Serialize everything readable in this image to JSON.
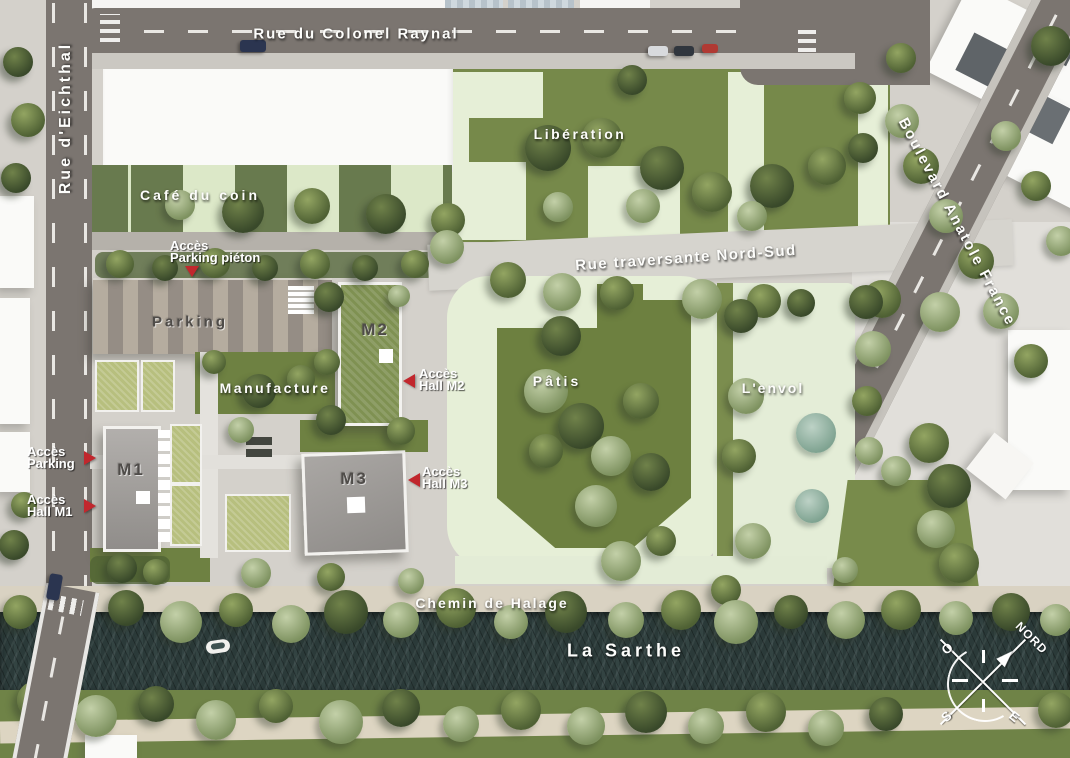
{
  "streets": {
    "colonel_raynal": "Rue du Colonel Raynal",
    "eichthal": "Rue d'Eichthal",
    "anatole_france": "Boulevard Anatole France",
    "traversante": "Rue traversante Nord-Sud",
    "halage": "Chemin de Halage"
  },
  "river": {
    "name": "La Sarthe"
  },
  "areas": {
    "liberation": "Libération",
    "cafe": "Café du coin",
    "parking": "Parking",
    "manufacture": "Manufacture",
    "patis": "Pâtis",
    "envol": "L'envol"
  },
  "buildings": {
    "m1": "M1",
    "m2": "M2",
    "m3": "M3"
  },
  "access": {
    "parking_pieton": [
      "Accès",
      "Parking piéton"
    ],
    "hall_m2": [
      "Accès",
      "Hall M2"
    ],
    "parking": [
      "Accès",
      "Parking"
    ],
    "hall_m1": [
      "Accès",
      "Hall M1"
    ],
    "hall_m3": [
      "Accès",
      "Hall M3"
    ]
  },
  "compass": {
    "north": "NORD",
    "west": "O",
    "south": "S",
    "east": "E"
  },
  "colors": {
    "marker_red": "#c1272d",
    "grass": "#76894a",
    "footprint_pale_green": "#e6efd7",
    "road_asphalt": "#7b7570",
    "river_water": "#2b3a39",
    "pavement": "#d4d1cb",
    "plaza": "#e1dfda",
    "garden_roof": "#b7bf7e",
    "parking_stripe_light": "#b5ac9f",
    "parking_stripe_dark": "#958d85"
  },
  "decor": {
    "trees": [
      [
        18,
        62,
        30,
        "dark"
      ],
      [
        28,
        120,
        34,
        "olive"
      ],
      [
        16,
        178,
        30,
        "dark"
      ],
      [
        24,
        505,
        26,
        "olive"
      ],
      [
        14,
        545,
        30,
        "dark"
      ],
      [
        243,
        212,
        42,
        "dark"
      ],
      [
        312,
        206,
        36,
        "olive"
      ],
      [
        386,
        214,
        40,
        "dark"
      ],
      [
        448,
        220,
        34,
        "olive"
      ],
      [
        180,
        205,
        30,
        "sage"
      ],
      [
        120,
        264,
        28,
        "olive"
      ],
      [
        165,
        268,
        26,
        "dark"
      ],
      [
        215,
        263,
        30,
        "olive"
      ],
      [
        265,
        268,
        26,
        "dark"
      ],
      [
        315,
        264,
        30,
        "olive"
      ],
      [
        365,
        268,
        26,
        "dark"
      ],
      [
        415,
        264,
        28,
        "olive"
      ],
      [
        548,
        148,
        46,
        "dark"
      ],
      [
        602,
        138,
        40,
        "olive"
      ],
      [
        662,
        168,
        44,
        "dark"
      ],
      [
        712,
        192,
        40,
        "olive"
      ],
      [
        772,
        186,
        44,
        "dark"
      ],
      [
        827,
        166,
        38,
        "olive"
      ],
      [
        632,
        80,
        30,
        "dark"
      ],
      [
        860,
        98,
        32,
        "olive"
      ],
      [
        863,
        148,
        30,
        "dark"
      ],
      [
        558,
        207,
        30,
        "sage"
      ],
      [
        643,
        206,
        34,
        "sage"
      ],
      [
        752,
        216,
        30,
        "sage"
      ],
      [
        447,
        247,
        34,
        "sage"
      ],
      [
        508,
        280,
        36,
        "olive"
      ],
      [
        562,
        292,
        38,
        "sage"
      ],
      [
        617,
        293,
        34,
        "olive"
      ],
      [
        702,
        299,
        40,
        "sage"
      ],
      [
        764,
        301,
        34,
        "olive"
      ],
      [
        882,
        299,
        38,
        "olive"
      ],
      [
        940,
        312,
        40,
        "sage"
      ],
      [
        329,
        297,
        30,
        "dark"
      ],
      [
        327,
        362,
        26,
        "olive"
      ],
      [
        331,
        420,
        30,
        "dark"
      ],
      [
        401,
        431,
        28,
        "olive"
      ],
      [
        399,
        296,
        22,
        "sage"
      ],
      [
        259,
        391,
        34,
        "dark"
      ],
      [
        301,
        379,
        28,
        "olive"
      ],
      [
        241,
        430,
        26,
        "sage"
      ],
      [
        214,
        362,
        24,
        "olive"
      ],
      [
        561,
        336,
        40,
        "dark"
      ],
      [
        546,
        391,
        44,
        "sage"
      ],
      [
        581,
        426,
        46,
        "dark"
      ],
      [
        611,
        456,
        40,
        "sage"
      ],
      [
        641,
        401,
        36,
        "olive"
      ],
      [
        651,
        472,
        38,
        "dark"
      ],
      [
        596,
        506,
        42,
        "sage"
      ],
      [
        546,
        451,
        34,
        "olive"
      ],
      [
        621,
        561,
        40,
        "sage"
      ],
      [
        661,
        541,
        30,
        "olive"
      ],
      [
        741,
        316,
        34,
        "dark"
      ],
      [
        746,
        396,
        36,
        "sage"
      ],
      [
        739,
        456,
        34,
        "olive"
      ],
      [
        753,
        541,
        36,
        "sage"
      ],
      [
        726,
        590,
        30,
        "olive"
      ],
      [
        816,
        433,
        40,
        "teal"
      ],
      [
        812,
        506,
        34,
        "teal"
      ],
      [
        801,
        303,
        28,
        "dark"
      ],
      [
        845,
        570,
        26,
        "sage"
      ],
      [
        866,
        302,
        34,
        "dark"
      ],
      [
        873,
        349,
        36,
        "sage"
      ],
      [
        867,
        401,
        30,
        "olive"
      ],
      [
        869,
        451,
        28,
        "sage"
      ],
      [
        929,
        443,
        40,
        "olive"
      ],
      [
        949,
        486,
        44,
        "dark"
      ],
      [
        936,
        529,
        38,
        "sage"
      ],
      [
        959,
        563,
        40,
        "olive"
      ],
      [
        896,
        471,
        30,
        "sage"
      ],
      [
        901,
        58,
        30,
        "olive"
      ],
      [
        902,
        121,
        34,
        "sage"
      ],
      [
        921,
        166,
        36,
        "olive"
      ],
      [
        946,
        216,
        34,
        "sage"
      ],
      [
        976,
        261,
        36,
        "olive"
      ],
      [
        1001,
        311,
        36,
        "sage"
      ],
      [
        1031,
        361,
        34,
        "olive"
      ],
      [
        1006,
        136,
        30,
        "sage"
      ],
      [
        1036,
        186,
        30,
        "olive"
      ],
      [
        1061,
        241,
        30,
        "sage"
      ],
      [
        1051,
        46,
        40,
        "dark"
      ],
      [
        122,
        568,
        30,
        "dark"
      ],
      [
        156,
        572,
        26,
        "olive"
      ],
      [
        256,
        573,
        30,
        "sage"
      ],
      [
        331,
        577,
        28,
        "olive"
      ],
      [
        411,
        581,
        26,
        "sage"
      ],
      [
        20,
        612,
        34,
        "olive"
      ],
      [
        72,
        620,
        40,
        "sage"
      ],
      [
        126,
        608,
        36,
        "dark"
      ],
      [
        181,
        622,
        42,
        "sage"
      ],
      [
        236,
        610,
        34,
        "olive"
      ],
      [
        291,
        624,
        38,
        "sage"
      ],
      [
        346,
        612,
        44,
        "dark"
      ],
      [
        401,
        620,
        36,
        "sage"
      ],
      [
        456,
        608,
        40,
        "olive"
      ],
      [
        511,
        622,
        34,
        "sage"
      ],
      [
        566,
        612,
        42,
        "dark"
      ],
      [
        626,
        620,
        36,
        "sage"
      ],
      [
        681,
        610,
        40,
        "olive"
      ],
      [
        736,
        622,
        44,
        "sage"
      ],
      [
        791,
        612,
        34,
        "dark"
      ],
      [
        846,
        620,
        38,
        "sage"
      ],
      [
        901,
        610,
        40,
        "olive"
      ],
      [
        956,
        618,
        34,
        "sage"
      ],
      [
        1011,
        612,
        38,
        "dark"
      ],
      [
        1056,
        620,
        32,
        "sage"
      ],
      [
        36,
        700,
        38,
        "olive"
      ],
      [
        96,
        716,
        42,
        "sage"
      ],
      [
        156,
        704,
        36,
        "dark"
      ],
      [
        216,
        720,
        40,
        "sage"
      ],
      [
        276,
        706,
        34,
        "olive"
      ],
      [
        341,
        722,
        44,
        "sage"
      ],
      [
        401,
        708,
        38,
        "dark"
      ],
      [
        461,
        724,
        36,
        "sage"
      ],
      [
        521,
        710,
        40,
        "olive"
      ],
      [
        586,
        726,
        38,
        "sage"
      ],
      [
        646,
        712,
        42,
        "dark"
      ],
      [
        706,
        726,
        36,
        "sage"
      ],
      [
        766,
        712,
        40,
        "olive"
      ],
      [
        826,
        728,
        36,
        "sage"
      ],
      [
        886,
        714,
        34,
        "dark"
      ],
      [
        1056,
        710,
        36,
        "olive"
      ]
    ]
  }
}
